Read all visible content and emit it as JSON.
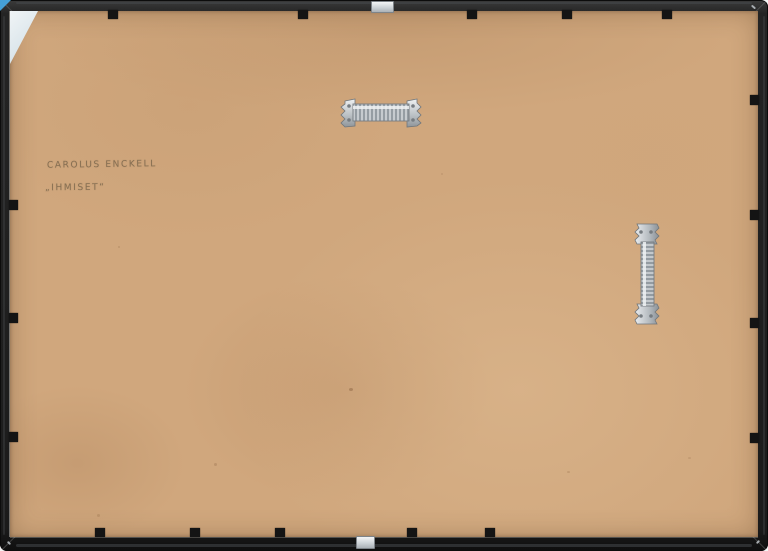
{
  "photo": {
    "subject": "Back of a framed artwork",
    "inscription": {
      "line1": "CAROLUS ENCKELL",
      "line2": "„IHMISET“"
    },
    "colors": {
      "frame_black": "#202020",
      "backing_tan": "#d0a77d",
      "hardware_silver": "#c6cbcf",
      "corner_card_pale": "#e3ebef",
      "photo_corner_blue": "#459fd6",
      "pencil_gray": "#806a4e"
    },
    "hardware": {
      "top_hanger": "sawtooth-hanger-icon-horizontal",
      "right_hanger": "sawtooth-hanger-icon-vertical",
      "top_clip": "spring-clip-icon",
      "bottom_clip": "spring-clip-icon"
    }
  }
}
